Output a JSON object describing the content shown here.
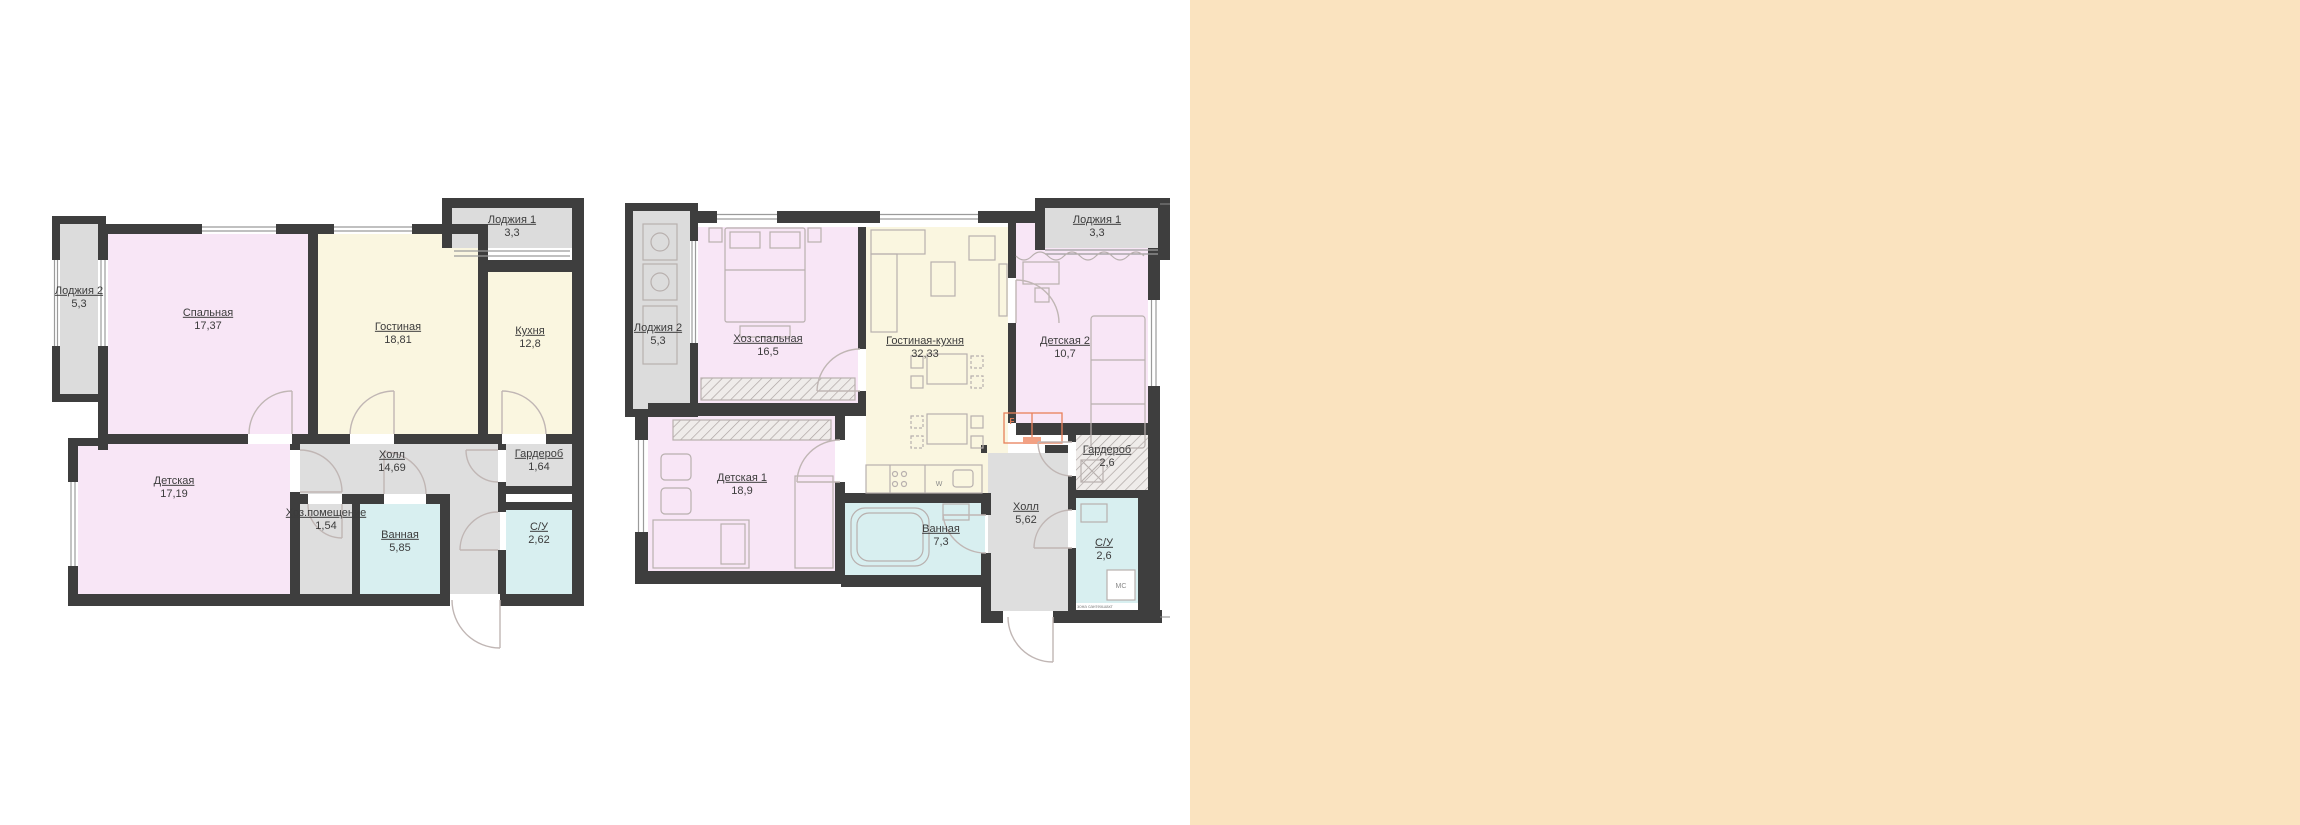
{
  "page": {
    "background": "#ffffff",
    "side_panel_color": "#fae3bf"
  },
  "palette": {
    "wall": "#3e3e3e",
    "room_pink": "#f8e6f6",
    "room_cream": "#faf6e0",
    "room_gray": "#dcdcdc",
    "room_cyan": "#d8eff0",
    "door_arc": "#c0b6b4",
    "furniture": "#b8b0ae",
    "accent_orange": "#e8805a",
    "label_text": "#3c3c3c"
  },
  "plans": [
    {
      "id": "left",
      "rooms": [
        {
          "key": "loggia2",
          "label": "Лоджия 2",
          "area": "5,3"
        },
        {
          "key": "spalnaya",
          "label": "Спальная",
          "area": "17,37"
        },
        {
          "key": "gostinaya",
          "label": "Гостиная",
          "area": "18,81"
        },
        {
          "key": "kuhnya",
          "label": "Кухня",
          "area": "12,8"
        },
        {
          "key": "loggia1",
          "label": "Лоджия 1",
          "area": "3,3"
        },
        {
          "key": "detskaya",
          "label": "Детская",
          "area": "17,19"
        },
        {
          "key": "holl",
          "label": "Холл",
          "area": "14,69"
        },
        {
          "key": "hoz",
          "label": "Хоз.помещение",
          "area": "1,54"
        },
        {
          "key": "vannaya",
          "label": "Ванная",
          "area": "5,85"
        },
        {
          "key": "garderob",
          "label": "Гардероб",
          "area": "1,64"
        },
        {
          "key": "su",
          "label": "С/У",
          "area": "2,62"
        }
      ]
    },
    {
      "id": "right",
      "rooms": [
        {
          "key": "loggia2",
          "label": "Лоджия 2",
          "area": "5,3"
        },
        {
          "key": "hoz_spalnaya",
          "label": "Хоз.спальная",
          "area": "16,5"
        },
        {
          "key": "gostinaya_kuhnya",
          "label": "Гостиная-кухня",
          "area": "32,33"
        },
        {
          "key": "detskaya2",
          "label": "Детская 2",
          "area": "10,7"
        },
        {
          "key": "loggia1",
          "label": "Лоджия 1",
          "area": "3,3"
        },
        {
          "key": "detskaya1",
          "label": "Детская 1",
          "area": "18,9"
        },
        {
          "key": "vannaya",
          "label": "Ванная",
          "area": "7,3"
        },
        {
          "key": "holl",
          "label": "Холл",
          "area": "5,62"
        },
        {
          "key": "garderob",
          "label": "Гардероб",
          "area": "2,6"
        },
        {
          "key": "su",
          "label": "С/У",
          "area": "2,6"
        }
      ],
      "annotations": {
        "fridge_mark": "F",
        "washer_mark": "МС",
        "sink_mark": "W",
        "shaft_note": "зона сантехшахт"
      }
    }
  ]
}
